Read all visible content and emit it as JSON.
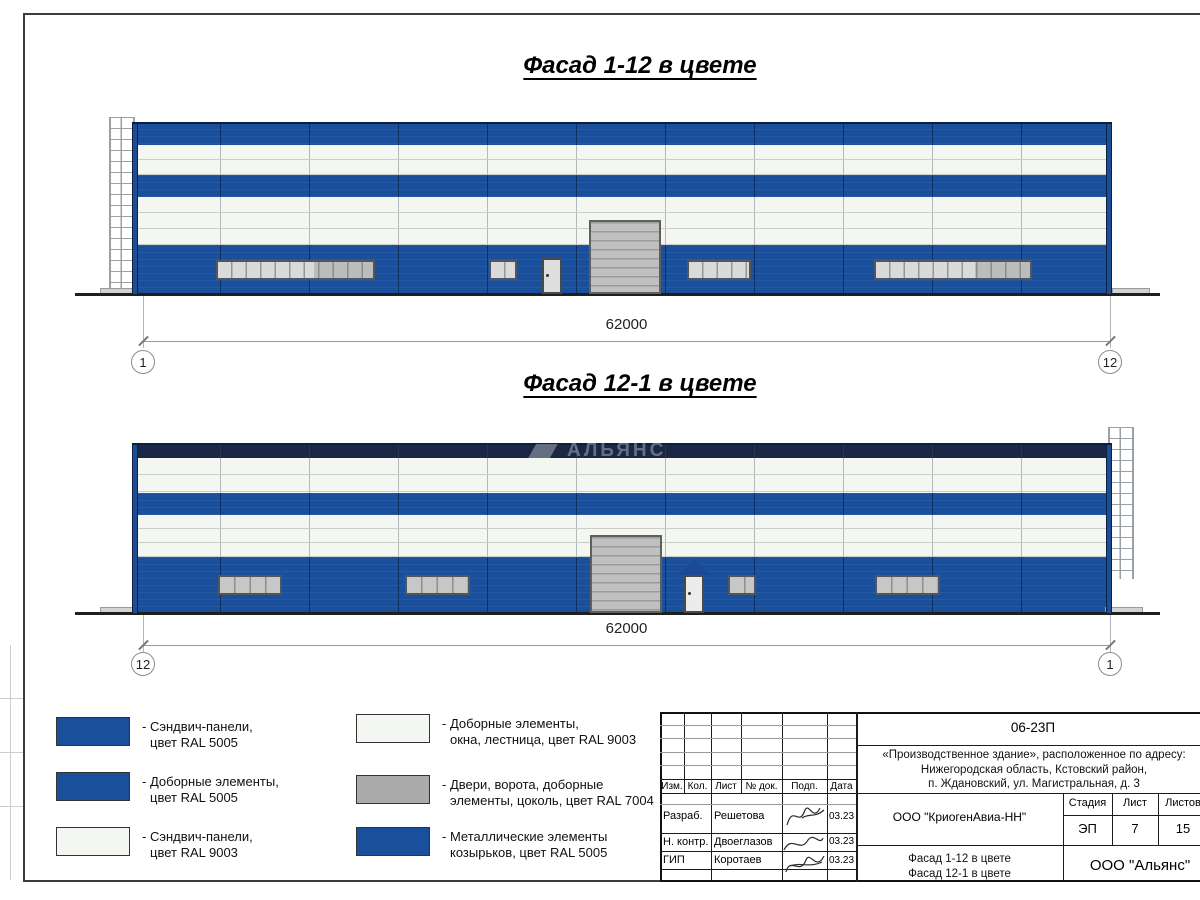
{
  "facades": [
    {
      "title": "Фасад 1-12 в цвете",
      "dim": "62000",
      "axis_left": "1",
      "axis_right": "12"
    },
    {
      "title": "Фасад 12-1 в цвете",
      "dim": "62000",
      "axis_left": "12",
      "axis_right": "1"
    }
  ],
  "watermark": "АЛЬЯНС",
  "colors": {
    "ral5005": "#1a4f9c",
    "ral9003": "#f3f6f1",
    "ral7004": "#ababab",
    "navy_parapet": "#1b2845"
  },
  "legend": {
    "items": [
      {
        "line1": "- Сэндвич-панели,",
        "line2": "цвет RAL 5005",
        "color": "#1a4f9c"
      },
      {
        "line1": "- Доборные элементы,",
        "line2": "цвет RAL 5005",
        "color": "#1a4f9c"
      },
      {
        "line1": "- Сэндвич-панели,",
        "line2": "цвет RAL 9003",
        "color": "#f3f6f1"
      },
      {
        "line1": "- Доборные элементы,",
        "line2": "окна, лестница, цвет RAL 9003",
        "color": "#f3f6f1"
      },
      {
        "line1": "- Двери, ворота, доборные",
        "line2": "элементы, цоколь, цвет RAL 7004",
        "color": "#ababab"
      },
      {
        "line1": "- Металлические элементы",
        "line2": "козырьков, цвет RAL 5005",
        "color": "#1a4f9c"
      }
    ]
  },
  "titleblock": {
    "doc_number": "06-23П",
    "project": {
      "line1": "«Производственное здание», расположенное по адресу:",
      "line2": "Нижегородская область, Кстовский район,",
      "line3": "п. Ждановский, ул. Магистральная, д. 3"
    },
    "columns": [
      "Изм.",
      "Кол.",
      "Лист",
      "№ док.",
      "Подп.",
      "Дата"
    ],
    "rows": [
      {
        "role": "Разраб.",
        "name": "Решетова",
        "date": "03.23"
      },
      {
        "role": "Н. контр.",
        "name": "Двоеглазов",
        "date": "03.23"
      },
      {
        "role": "ГИП",
        "name": "Коротаев",
        "date": "03.23"
      }
    ],
    "company": "ООО \"КриогенАвиа-НН\"",
    "stage_label": "Стадия",
    "sheet_label": "Лист",
    "sheets_label": "Листов",
    "stage": "ЭП",
    "sheet_no": "7",
    "sheets_total": "15",
    "subject": {
      "line1": "Фасад 1-12 в цвете",
      "line2": "Фасад 12-1 в цвете"
    },
    "org": "ООО \"Альянс\""
  }
}
